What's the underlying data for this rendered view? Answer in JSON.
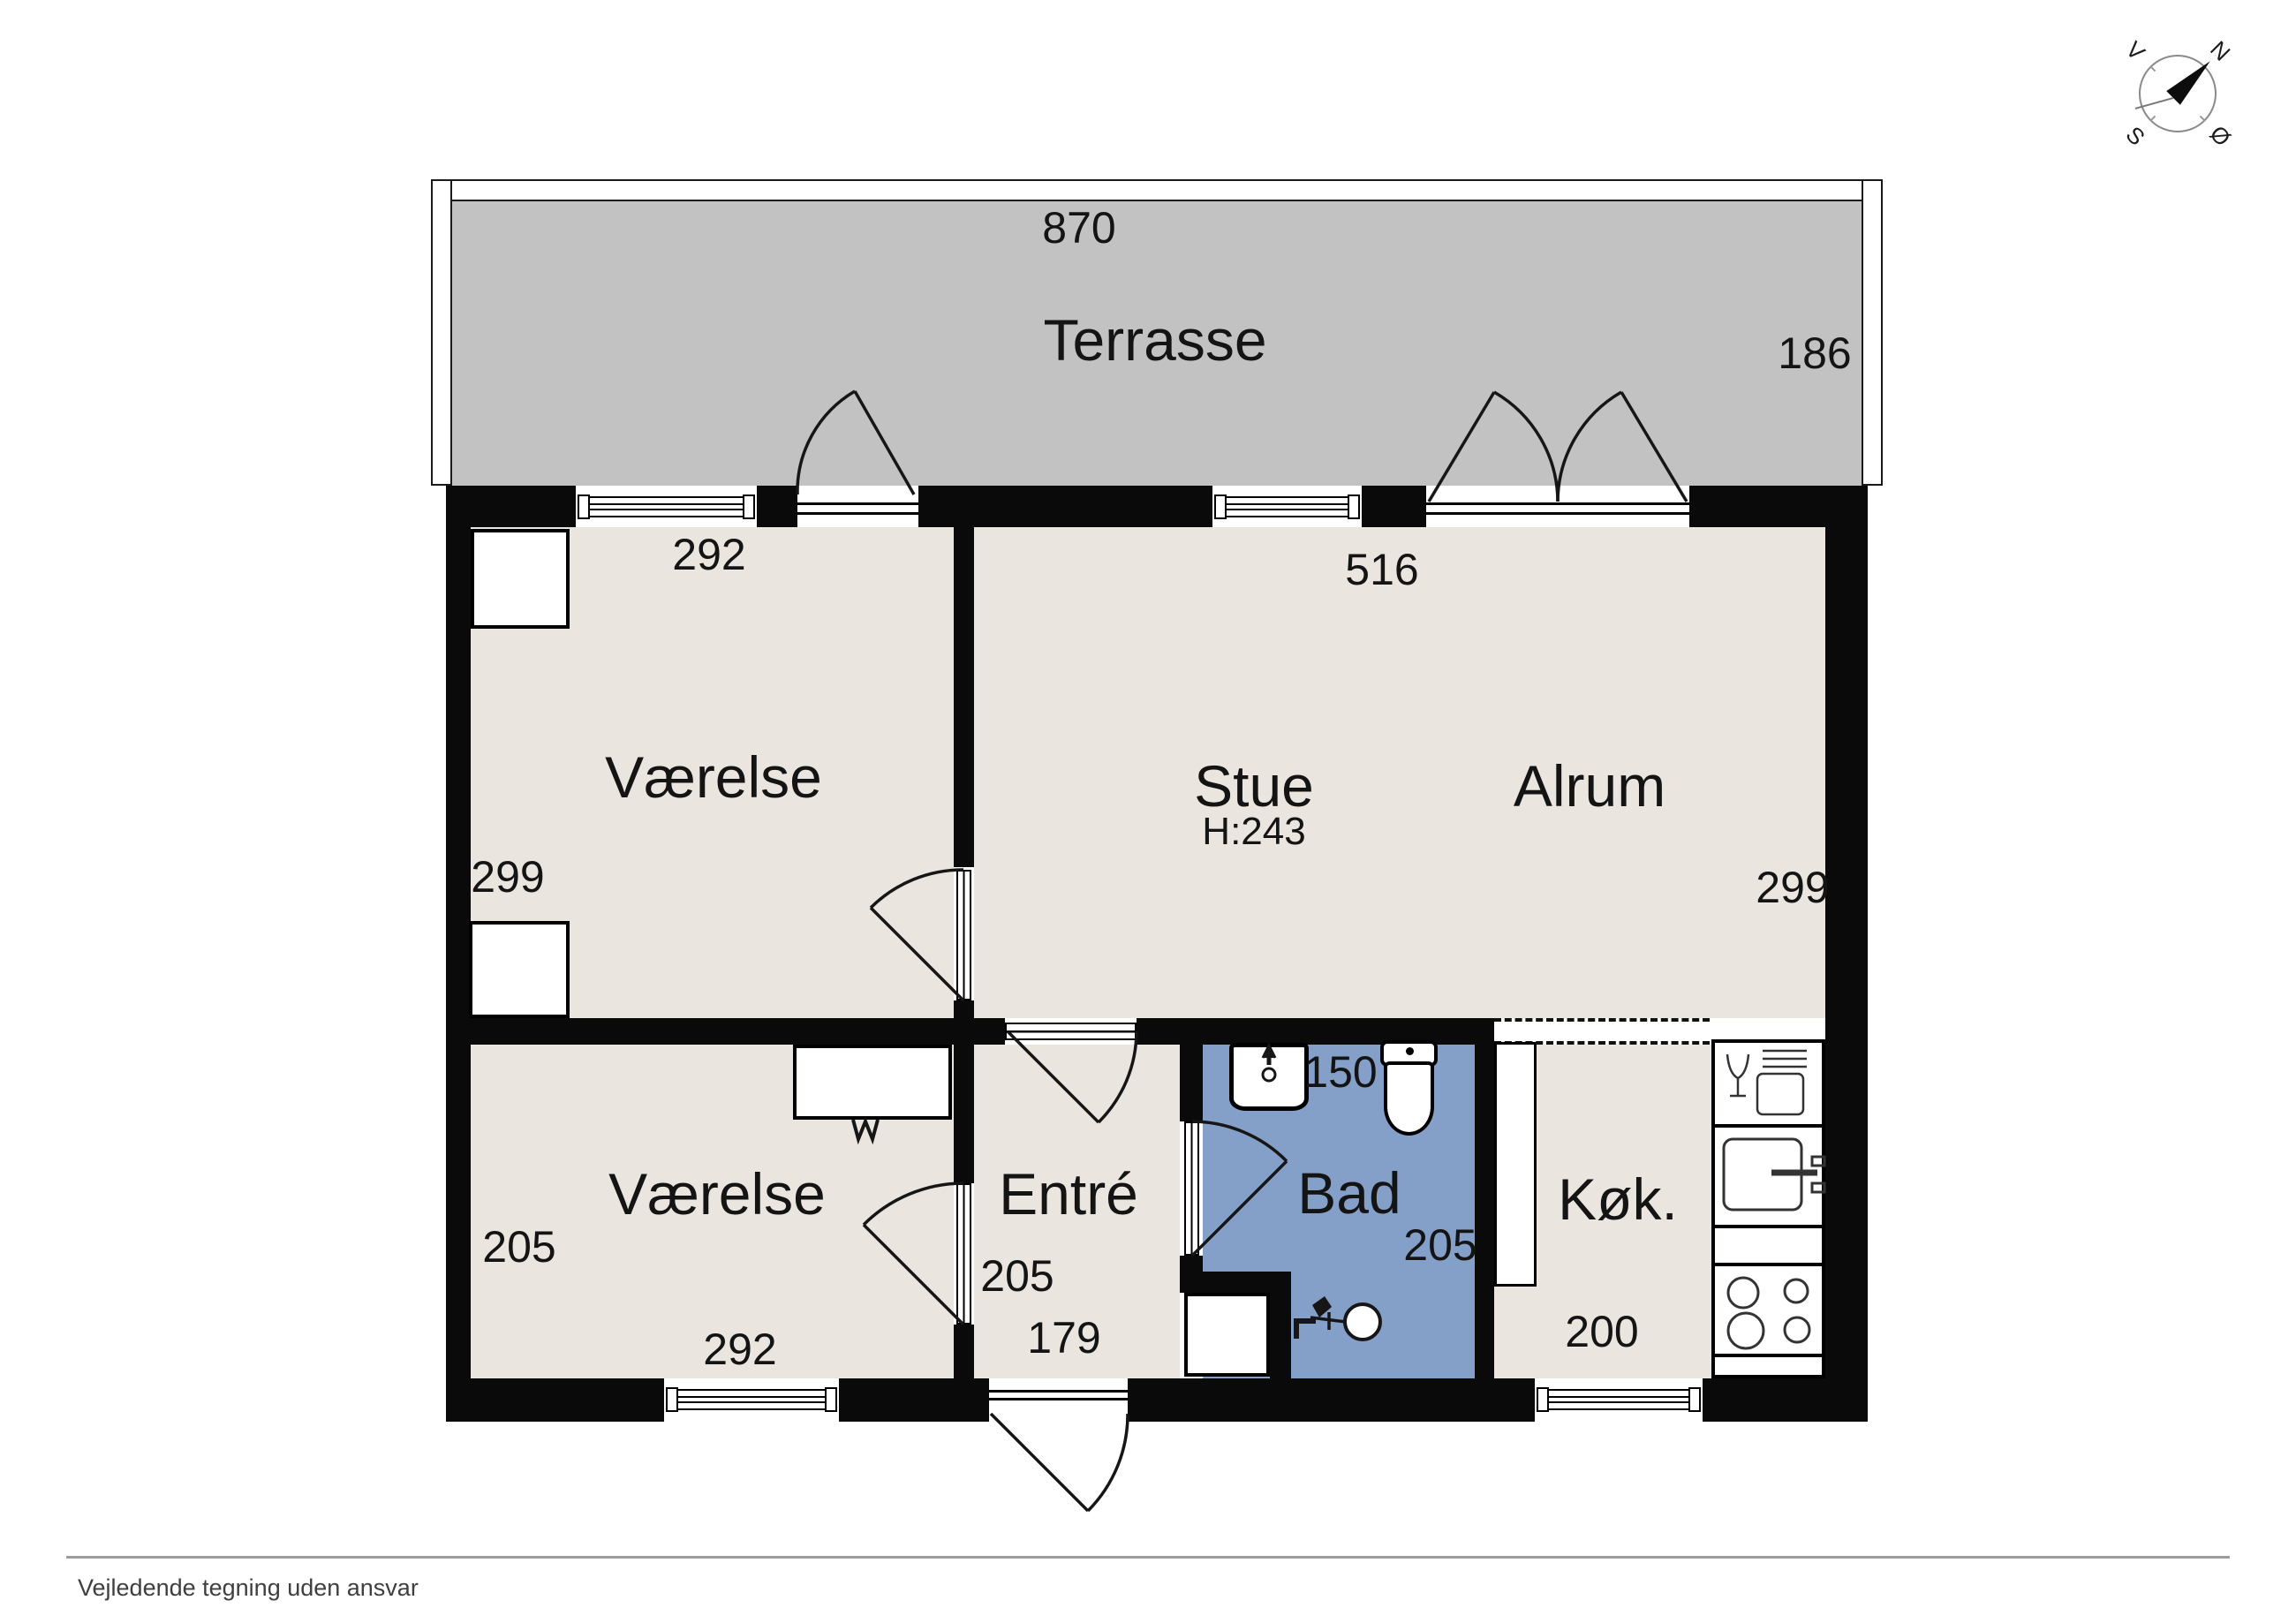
{
  "title": "Floor plan",
  "rooms": {
    "terrasse": {
      "name": "Terrasse",
      "width": "870",
      "depth": "186"
    },
    "vaerelse_top": {
      "name": "Værelse",
      "width": "292",
      "depth": "299"
    },
    "stue": {
      "name": "Stue",
      "ceiling_height": "H:243"
    },
    "alrum": {
      "name": "Alrum",
      "width": "516",
      "depth": "299"
    },
    "vaerelse_bottom": {
      "name": "Værelse",
      "width": "292",
      "depth": "205"
    },
    "entre": {
      "name": "Entré",
      "depth": "205",
      "width": "179"
    },
    "bad": {
      "name": "Bad",
      "width": "150",
      "depth": "205"
    },
    "kok": {
      "name": "Køk.",
      "width": "200"
    }
  },
  "compass": {
    "north": "N",
    "south": "S",
    "east": "Ø",
    "west": "V"
  },
  "footer": {
    "disclaimer": "Vejledende tegning uden ansvar"
  },
  "colors": {
    "floor": "#eae5de",
    "terrace": "#c2c2c2",
    "bath": "#84a0c8",
    "wall": "#0a0a0a"
  }
}
